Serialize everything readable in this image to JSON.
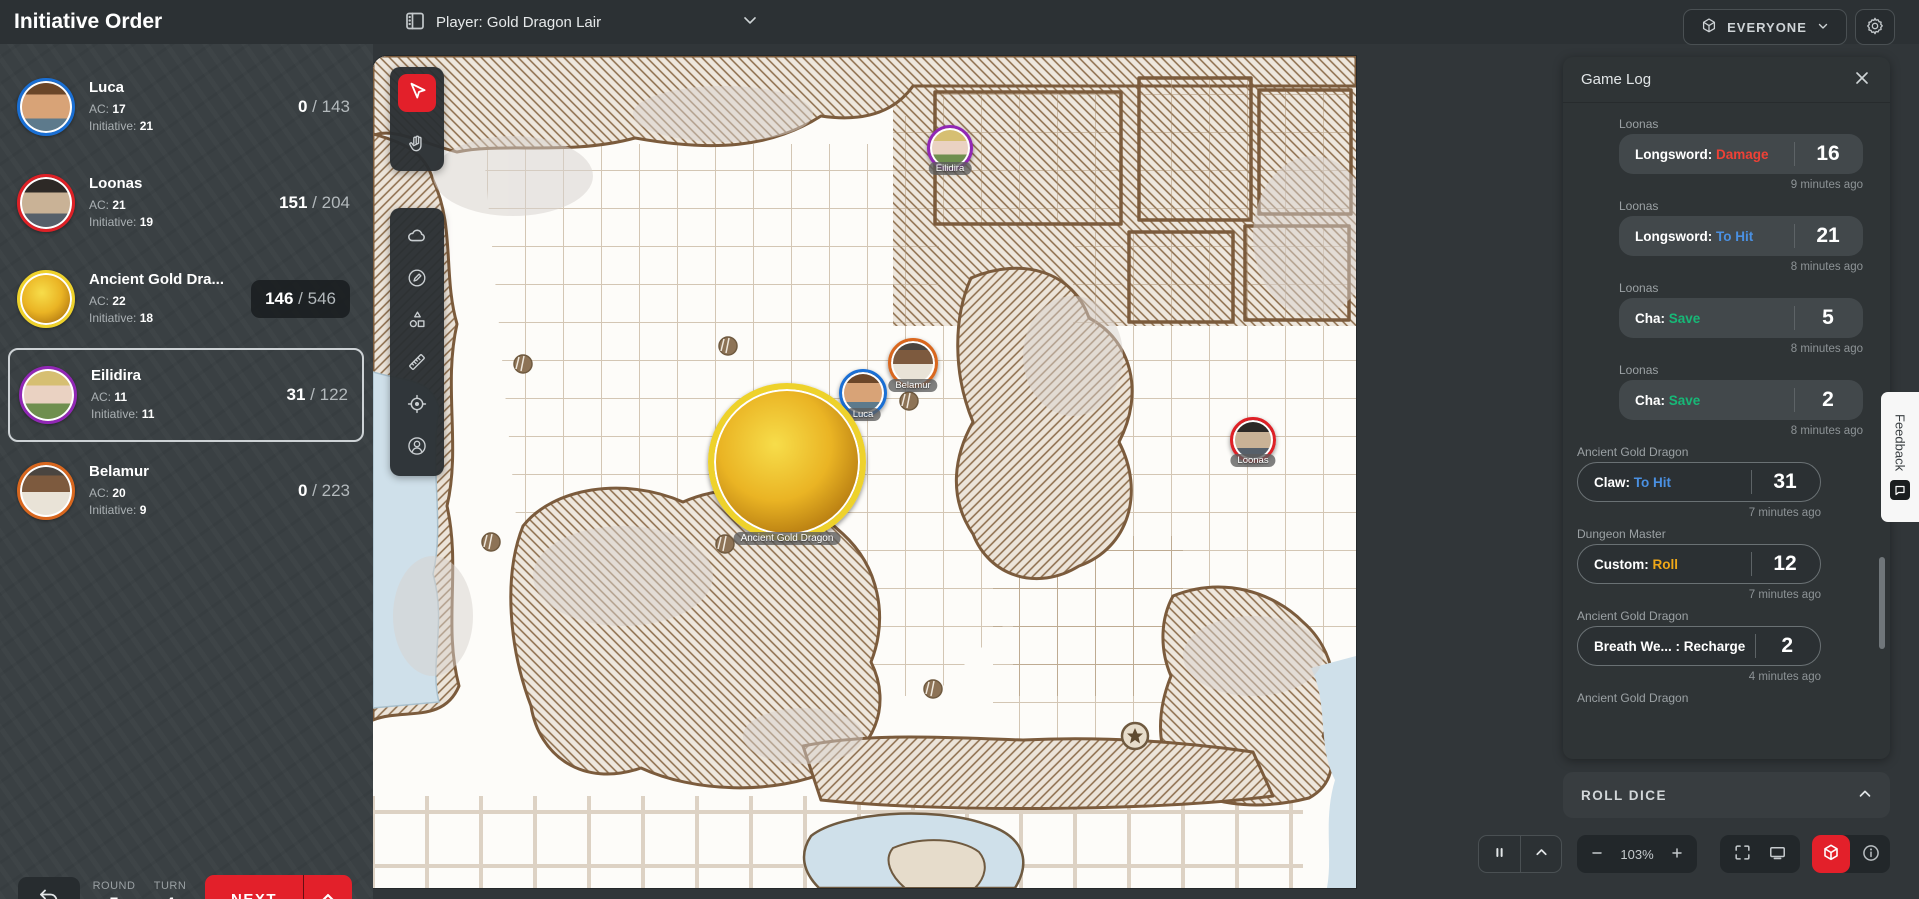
{
  "header": {
    "title": "Initiative Order",
    "map_select": "Player: Gold Dragon Lair",
    "everyone_label": "EVERYONE"
  },
  "initiative": {
    "ac_label": "AC:",
    "initiative_label": "Initiative:",
    "items": [
      {
        "name": "Luca",
        "ac": "17",
        "initiative": "21",
        "hp": "0",
        "hp_max": "143",
        "ring_color": "#1a6fd4",
        "portrait": "luca",
        "active": false,
        "hp_boxed": false
      },
      {
        "name": "Loonas",
        "ac": "21",
        "initiative": "19",
        "hp": "151",
        "hp_max": "204",
        "ring_color": "#de2026",
        "portrait": "loonas",
        "active": false,
        "hp_boxed": false
      },
      {
        "name": "Ancient Gold Dra...",
        "ac": "22",
        "initiative": "18",
        "hp": "146",
        "hp_max": "546",
        "ring_color": "#eed22b",
        "portrait": "dragon",
        "active": false,
        "hp_boxed": true
      },
      {
        "name": "Eilidira",
        "ac": "11",
        "initiative": "11",
        "hp": "31",
        "hp_max": "122",
        "ring_color": "#9127b5",
        "portrait": "eilidira",
        "active": true,
        "hp_boxed": false
      },
      {
        "name": "Belamur",
        "ac": "20",
        "initiative": "9",
        "hp": "0",
        "hp_max": "223",
        "ring_color": "#d9671e",
        "portrait": "belamur",
        "active": false,
        "hp_boxed": false
      }
    ]
  },
  "turn_tracker": {
    "round_label": "ROUND",
    "round_value": "5",
    "turn_label": "TURN",
    "turn_value": "4",
    "next_label": "NEXT"
  },
  "toolbar": {
    "groups": [
      {
        "tools": [
          {
            "id": "select",
            "icon": "cursor-icon",
            "active": true
          },
          {
            "id": "pan",
            "icon": "hand-icon",
            "active": false
          }
        ]
      },
      {
        "tools": [
          {
            "id": "fog",
            "icon": "cloud-icon",
            "active": false
          },
          {
            "id": "draw",
            "icon": "pen-circle-icon",
            "active": false
          },
          {
            "id": "shapes",
            "icon": "shapes-icon",
            "active": false
          },
          {
            "id": "measure",
            "icon": "ruler-icon",
            "active": false
          },
          {
            "id": "ping",
            "icon": "crosshair-icon",
            "active": false
          },
          {
            "id": "character",
            "icon": "person-circle-icon",
            "active": false
          }
        ]
      }
    ]
  },
  "map": {
    "tokens": [
      {
        "label": "Eilidira",
        "x": 577,
        "y": 92,
        "size": 46,
        "ring_color": "#9127b5",
        "portrait": "eilidira"
      },
      {
        "label": "Belamur",
        "x": 540,
        "y": 307,
        "size": 50,
        "ring_color": "#d9671e",
        "portrait": "belamur"
      },
      {
        "label": "Luca",
        "x": 490,
        "y": 337,
        "size": 48,
        "ring_color": "#1a6fd4",
        "portrait": "luca"
      },
      {
        "label": "Ancient Gold Dragon",
        "x": 414,
        "y": 406,
        "size": 158,
        "ring_color": "#eed22b",
        "portrait": "dragon"
      },
      {
        "label": "Loonas",
        "x": 880,
        "y": 384,
        "size": 46,
        "ring_color": "#de2026",
        "portrait": "loonas"
      }
    ]
  },
  "game_log": {
    "title": "Game Log",
    "roll_dice_label": "ROLL DICE",
    "entries": [
      {
        "actor": "Loonas",
        "label": "Longsword:",
        "action": "Damage",
        "action_color": "#ef4136",
        "value": "16",
        "time": "9 minutes ago",
        "variant": "filled"
      },
      {
        "actor": "Loonas",
        "label": "Longsword:",
        "action": "To Hit",
        "action_color": "#4a90e2",
        "value": "21",
        "time": "8 minutes ago",
        "variant": "filled"
      },
      {
        "actor": "Loonas",
        "label": "Cha:",
        "action": "Save",
        "action_color": "#17b877",
        "value": "5",
        "time": "8 minutes ago",
        "variant": "filled"
      },
      {
        "actor": "Loonas",
        "label": "Cha:",
        "action": "Save",
        "action_color": "#17b877",
        "value": "2",
        "time": "8 minutes ago",
        "variant": "filled"
      },
      {
        "actor": "Ancient Gold Dragon",
        "label": "Claw:",
        "action": "To Hit",
        "action_color": "#4a90e2",
        "value": "31",
        "time": "7 minutes ago",
        "variant": "outlined"
      },
      {
        "actor": "Dungeon Master",
        "label": "Custom:",
        "action": "Roll",
        "action_color": "#f0a818",
        "value": "12",
        "time": "7 minutes ago",
        "variant": "outlined"
      },
      {
        "actor": "Ancient Gold Dragon",
        "label": "Breath We... :",
        "action": "Recharge",
        "action_color": "#ffffff",
        "value": "2",
        "time": "4 minutes ago",
        "variant": "outlined"
      },
      {
        "actor": "Ancient Gold Dragon",
        "label": "",
        "action": "",
        "action_color": "",
        "value": "",
        "time": "",
        "variant": "partial"
      }
    ]
  },
  "bottom_controls": {
    "zoom_out": "−",
    "zoom_level": "103%",
    "zoom_in": "+"
  },
  "feedback": {
    "label": "Feedback"
  },
  "colors": {
    "accent": "#e3202a",
    "to_hit": "#4a90e2",
    "damage": "#ef4136",
    "save": "#17b877",
    "roll": "#f0a818"
  }
}
